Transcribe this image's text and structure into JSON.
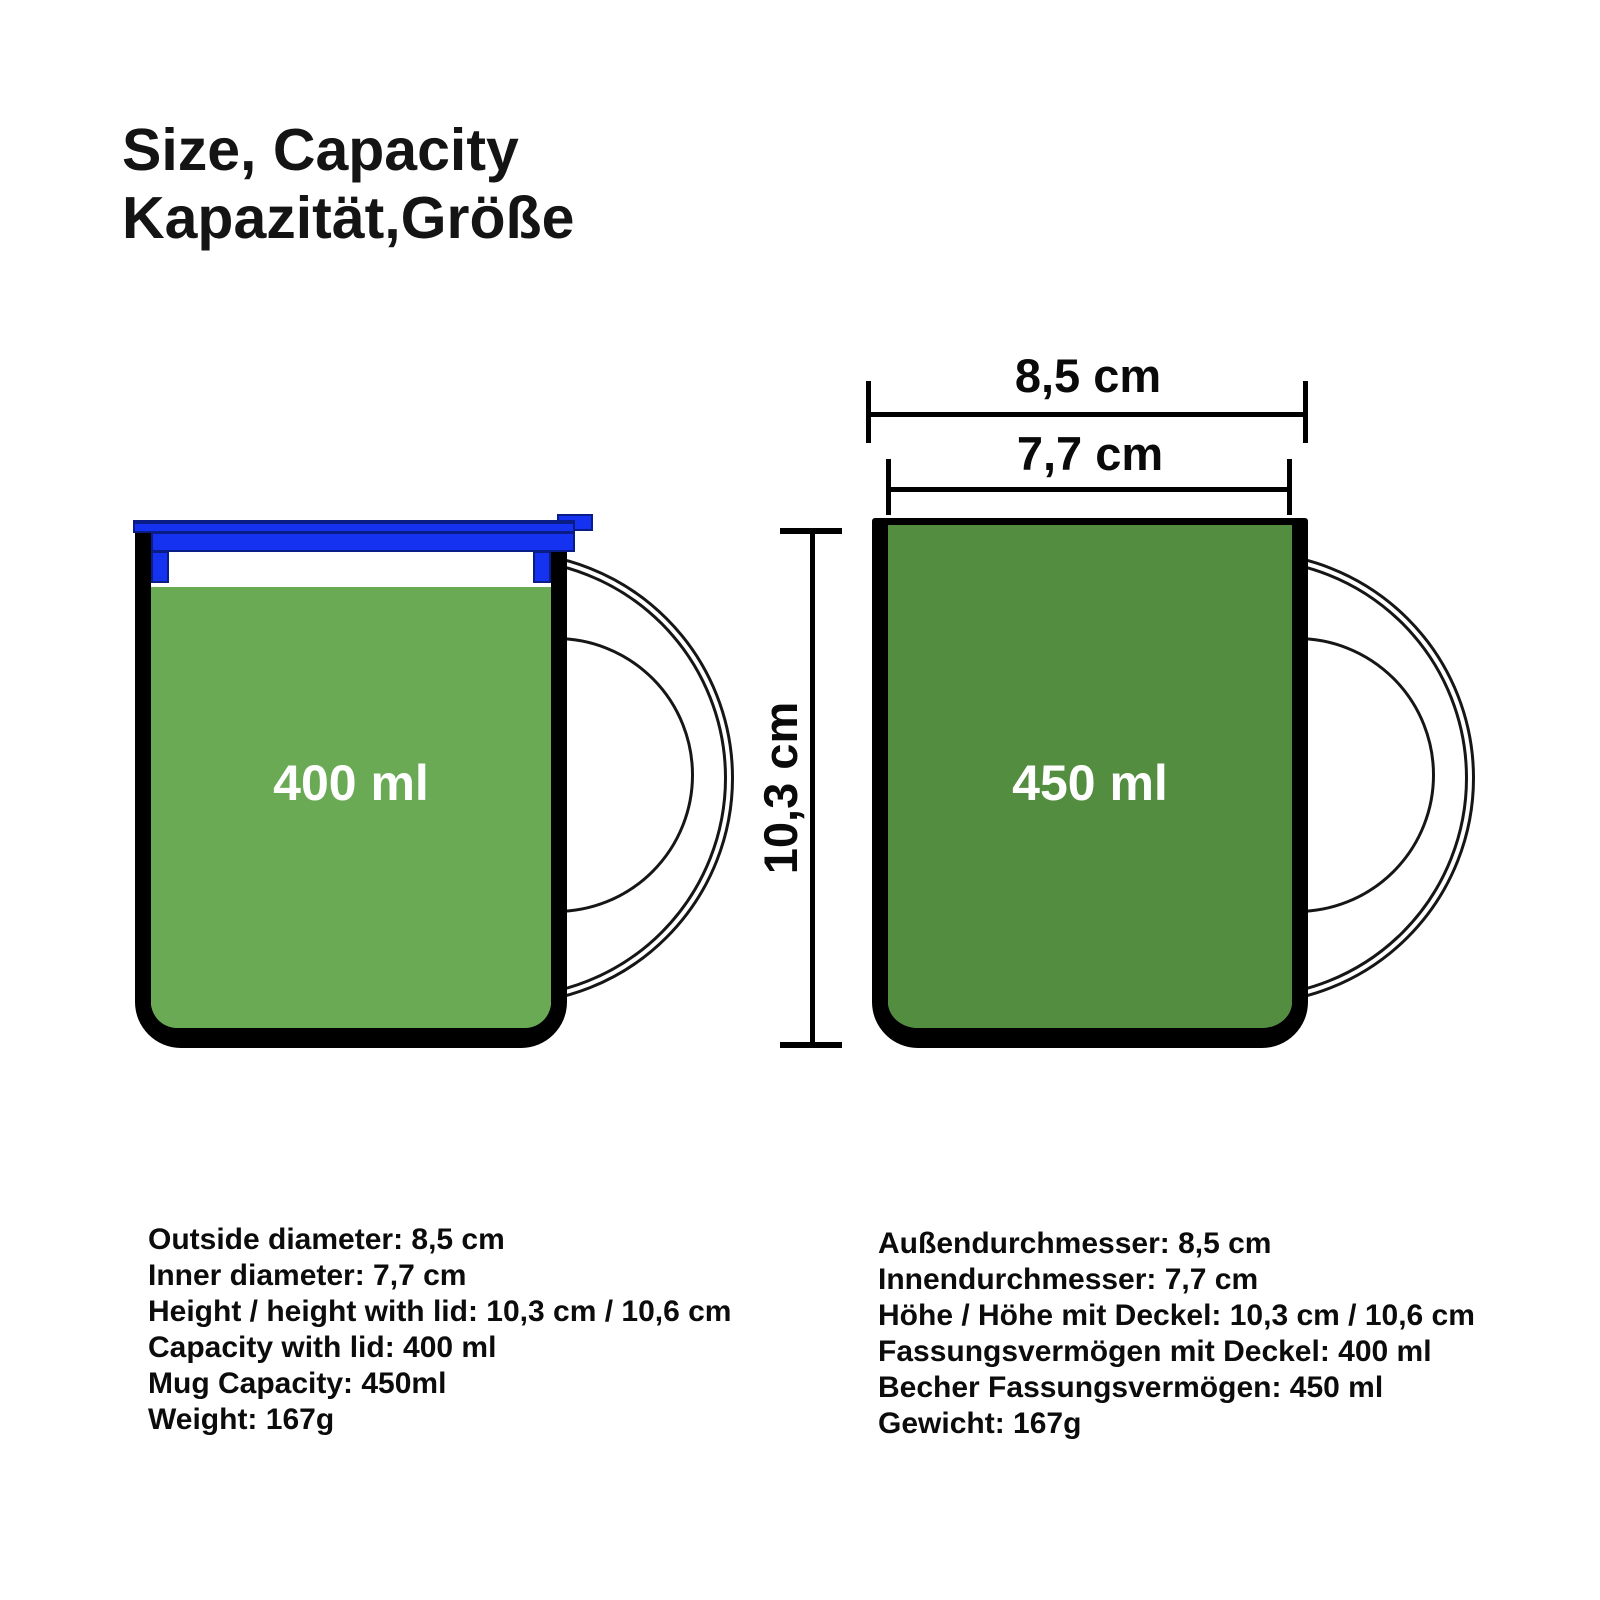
{
  "title": {
    "line1": "Size, Capacity",
    "line2": "Kapazität,Größe"
  },
  "diagram": {
    "left_mug": {
      "capacity_label": "400 ml"
    },
    "right_mug": {
      "capacity_label": "450 ml"
    },
    "dims": {
      "outer_diameter": "8,5 cm",
      "inner_diameter": "7,7 cm",
      "height": "10,3 cm"
    }
  },
  "specs_en": {
    "lines": [
      "Outside diameter: 8,5 cm",
      "Inner diameter: 7,7 cm",
      "Height / height with lid: 10,3 cm / 10,6 cm",
      "Capacity with lid: 400 ml",
      "Mug Capacity: 450ml",
      "Weight: 167g"
    ]
  },
  "specs_de": {
    "lines": [
      "Außendurchmesser: 8,5 cm",
      "Innendurchmesser: 7,7 cm",
      "Höhe / Höhe mit Deckel: 10,3 cm / 10,6 cm",
      "Fassungsvermögen mit Deckel: 400 ml",
      "Becher Fassungsvermögen: 450 ml",
      "Gewicht: 167g"
    ]
  },
  "colors": {
    "mug_fill_left": "#6AAA55",
    "mug_fill_right": "#538D40",
    "lid_blue": "#1532F0",
    "lid_edge": "#0A1C85",
    "outline": "#000000"
  }
}
